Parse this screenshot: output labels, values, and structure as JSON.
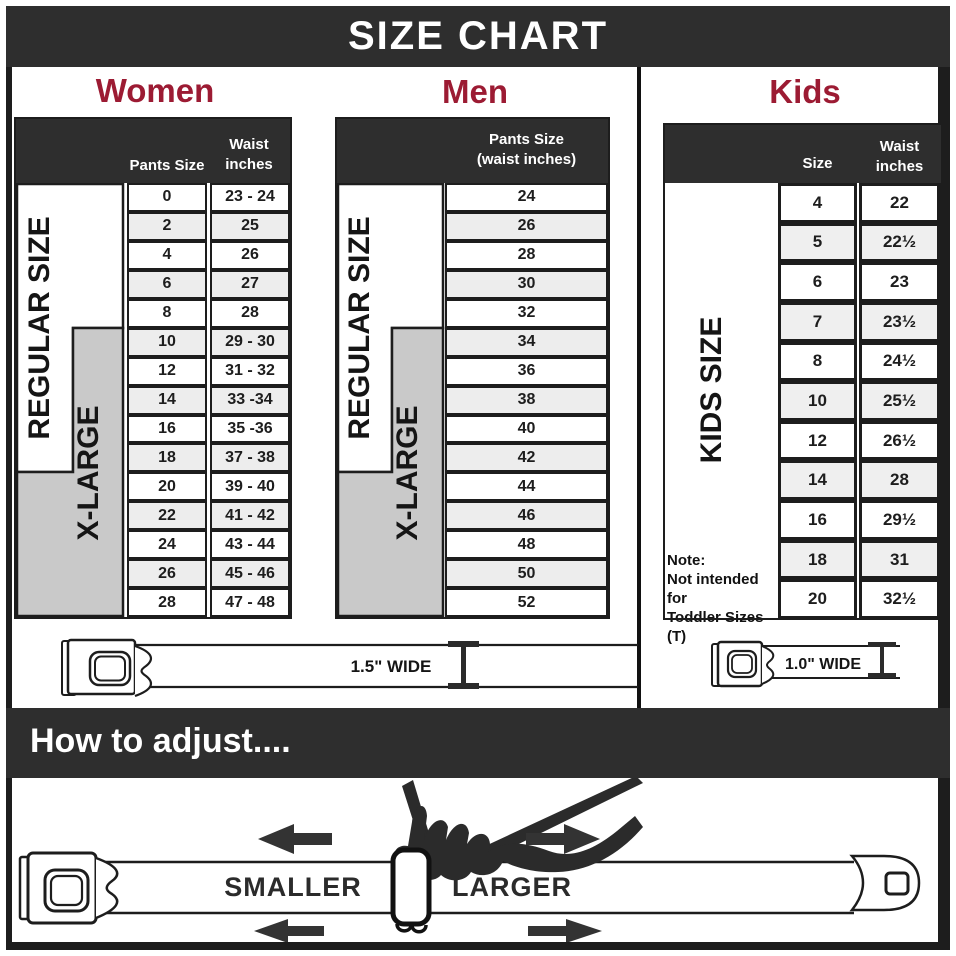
{
  "banner": {
    "title": "SIZE CHART"
  },
  "column_headers": {
    "women": "Women",
    "men": "Men",
    "kids": "Kids"
  },
  "chart_data": [
    {
      "type": "table",
      "group": "Women",
      "columns": [
        "Pants Size",
        "Waist inches"
      ],
      "size_bands": [
        {
          "label": "REGULAR SIZE",
          "covers_sizes": "0-18"
        },
        {
          "label": "X-LARGE",
          "covers_sizes": "10-28"
        }
      ],
      "rows": [
        [
          "0",
          "23 - 24"
        ],
        [
          "2",
          "25"
        ],
        [
          "4",
          "26"
        ],
        [
          "6",
          "27"
        ],
        [
          "8",
          "28"
        ],
        [
          "10",
          "29 - 30"
        ],
        [
          "12",
          "31 - 32"
        ],
        [
          "14",
          "33 -34"
        ],
        [
          "16",
          "35 -36"
        ],
        [
          "18",
          "37 - 38"
        ],
        [
          "20",
          "39 - 40"
        ],
        [
          "22",
          "41 - 42"
        ],
        [
          "24",
          "43 - 44"
        ],
        [
          "26",
          "45 - 46"
        ],
        [
          "28",
          "47 - 48"
        ]
      ]
    },
    {
      "type": "table",
      "group": "Men",
      "columns": [
        "Pants Size",
        "(waist inches)"
      ],
      "size_bands": [
        {
          "label": "REGULAR SIZE",
          "covers_sizes": "24-42"
        },
        {
          "label": "X-LARGE",
          "covers_sizes": "34-52"
        }
      ],
      "rows": [
        [
          "24"
        ],
        [
          "26"
        ],
        [
          "28"
        ],
        [
          "30"
        ],
        [
          "32"
        ],
        [
          "34"
        ],
        [
          "36"
        ],
        [
          "38"
        ],
        [
          "40"
        ],
        [
          "42"
        ],
        [
          "44"
        ],
        [
          "46"
        ],
        [
          "48"
        ],
        [
          "50"
        ],
        [
          "52"
        ]
      ]
    },
    {
      "type": "table",
      "group": "Kids",
      "columns": [
        "Size",
        "Waist inches"
      ],
      "size_bands": [
        {
          "label": "KIDS SIZE",
          "covers_sizes": "4-20"
        }
      ],
      "rows": [
        [
          "4",
          "22"
        ],
        [
          "5",
          "22½"
        ],
        [
          "6",
          "23"
        ],
        [
          "7",
          "23½"
        ],
        [
          "8",
          "24½"
        ],
        [
          "10",
          "25½"
        ],
        [
          "12",
          "26½"
        ],
        [
          "14",
          "28"
        ],
        [
          "16",
          "29½"
        ],
        [
          "18",
          "31"
        ],
        [
          "20",
          "32½"
        ]
      ],
      "note": {
        "title": "Note:",
        "line1": "Not intended for",
        "line2": "Toddler Sizes (T)"
      }
    }
  ],
  "belts": {
    "adult_width_label": "1.5\" WIDE",
    "kids_width_label": "1.0\" WIDE"
  },
  "adjust": {
    "heading": "How to adjust....",
    "smaller": "SMALLER",
    "larger": "LARGER"
  },
  "colors": {
    "banner_bg": "#2e2e2e",
    "accent": "#9c1b33",
    "xlarge_gray": "#c9c9c9",
    "row_alt": "#ededed",
    "outline": "#1d1d1d",
    "arrow": "#333333"
  }
}
